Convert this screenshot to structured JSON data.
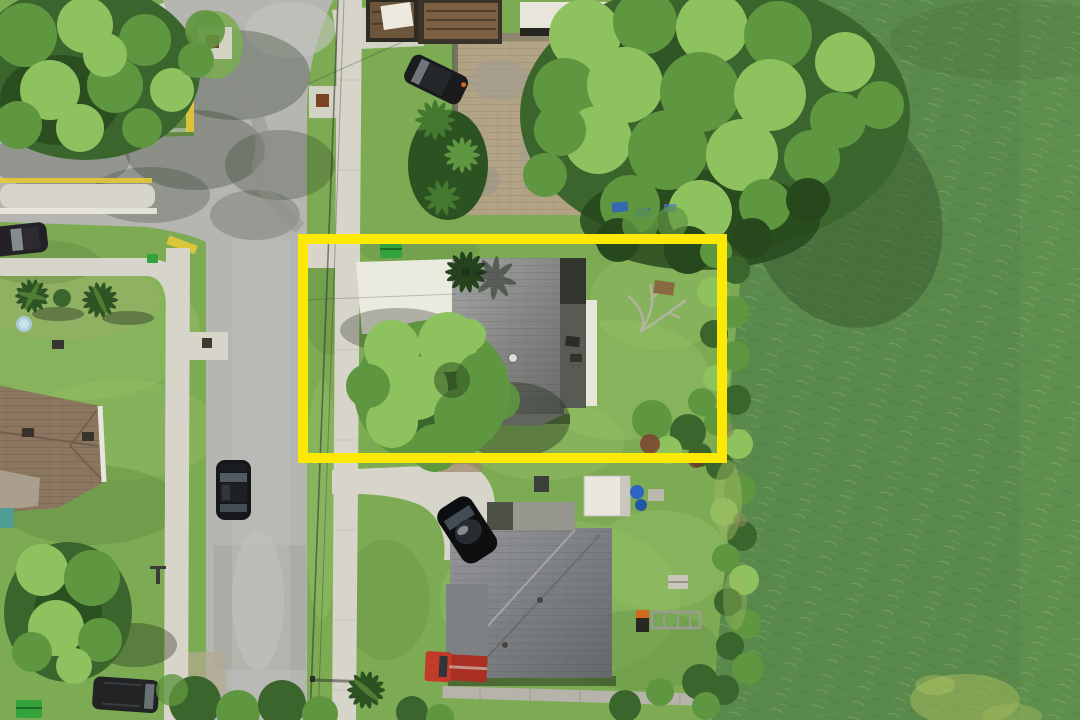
{
  "scene": {
    "title": "Aerial drone photo of lakefront residential lot",
    "type": "drone-aerial-photograph",
    "setting": "Single-family neighborhood beside a green lake, midday sun",
    "annotation": {
      "kind": "property-boundary-highlight",
      "shape": "rectangle",
      "color": "#fde903",
      "bounds_px": {
        "x": 303,
        "y": 239,
        "width": 419,
        "height": 219
      }
    },
    "features": [
      {
        "name": "highlighted-lot",
        "description": "Gray-roof single-story house, bright concrete driveway, large shade tree over the left of the roof, lawn, dead branch pile and shrubs in rear yard, green trash bin at curb"
      },
      {
        "name": "lake",
        "description": "Green rippled lake water along the right edge with vegetated shoreline band and algae patch at bottom right"
      },
      {
        "name": "street",
        "description": "Two-lane light asphalt street running vertically with concrete sidewalks on both sides and overhead utility lines"
      },
      {
        "name": "intersection",
        "description": "T-intersection at upper left with concrete median island striped yellow and white, yellow-painted curbs, storm utility pads"
      },
      {
        "name": "neighbor-house-north",
        "description": "Tan paver roof house shaded by a huge tree canopy, dark SUV in driveway, palm cluster, trailers and flatbed trucks parked along the top edge, blue tarps under the tree"
      },
      {
        "name": "neighbor-house-south",
        "description": "Gray-roof house with curved driveway, black car, red pickup truck, white shed with blue barrels, long footpath to the lake"
      },
      {
        "name": "neighbor-house-west",
        "description": "Brown hip-roof house at lower left with palms, kiddie pool and large yard tree"
      },
      {
        "name": "vehicles",
        "description": "Black SUV parked on street, sedan under intersection trees, sedan at left edge, minivan on lawn at bottom left"
      }
    ]
  },
  "colors": {
    "water": "#59894b",
    "waterLight": "#77a35e",
    "waterDark": "#33512c",
    "grass": "#7cab53",
    "grassLight": "#9fc76e",
    "grassDark": "#557f3c",
    "road": "#b5b5b1",
    "roadDark": "#9a9c94",
    "concrete": "#d7d5ca",
    "concreteBright": "#ebeadf",
    "roofGray1": "#a0a2a0",
    "roofGray2": "#6d6f6d",
    "roofDark": "#41453c",
    "roofWhite": "#e7e5dc",
    "roofTan": "#b3a385",
    "roofBrown": "#8b7660",
    "treeLight": "#8ec25e",
    "treeMid": "#5f9640",
    "treeDark": "#3a652c",
    "treeDeep": "#27481d",
    "shadow": "#1d2b18",
    "highlight": "#fde903",
    "curbYellow": "#e6c937",
    "carBlack": "#15171a",
    "glass": "#58616a",
    "truckRed": "#c23a28",
    "tarpBlue": "#2f63c4",
    "binGreen": "#33a23c",
    "branchGray": "#b9b4a5"
  }
}
